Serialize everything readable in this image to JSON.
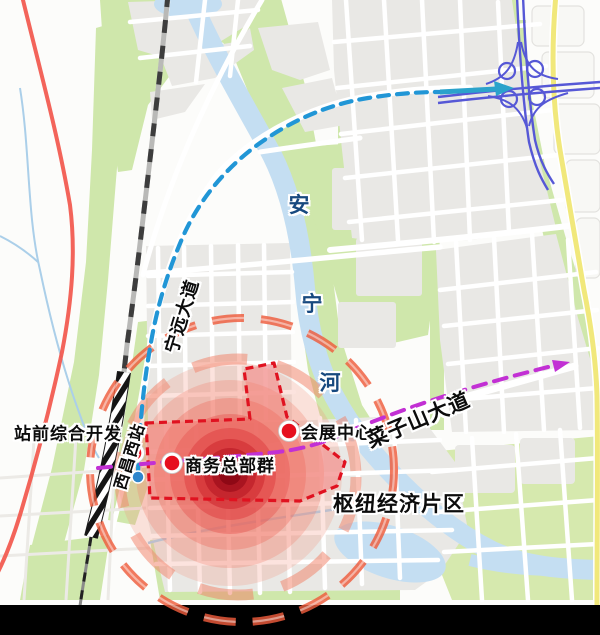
{
  "map": {
    "labels": {
      "station_development": "站前综合开发",
      "west_station": "西昌西站",
      "business_hq": "商务总部群",
      "convention_center": "会展中心",
      "hub_economic_area": "枢纽经济片区",
      "ningyuan_avenue": "宁远大道",
      "caizishan_avenue": "菜子山大道",
      "river_char_an": "安",
      "river_char_ning": "宁",
      "river_char_he": "河"
    },
    "markers": [
      {
        "id": "station-marker",
        "label": "站前综合开发"
      },
      {
        "id": "business-hq-marker",
        "label": "商务总部群"
      },
      {
        "id": "convention-center-marker",
        "label": "会展中心"
      },
      {
        "id": "rail-station-dot",
        "label": "西昌西站"
      }
    ],
    "colors": {
      "marker_red": "#e60f1e",
      "zone_fill_pink": "#f49ea1",
      "zone_border_red": "#e01220",
      "ring_salmon": "#ee5c3c",
      "route_blue_dashed": "#2196d6",
      "route_arrow_teal": "#2ba3cb",
      "route_magenta_dashed": "#c230d4",
      "railway_dark": "#3d3d3d",
      "rail_line_red": "#f2574c",
      "highway_yellow": "#f1e87b",
      "interchange_indigo": "#5658d6",
      "river_blue": "#c4def2",
      "river_label_blue": "#17497f",
      "green_area": "#cfe7ab",
      "block_gray": "#e9e8e5",
      "bottom_band": "#000000"
    }
  }
}
